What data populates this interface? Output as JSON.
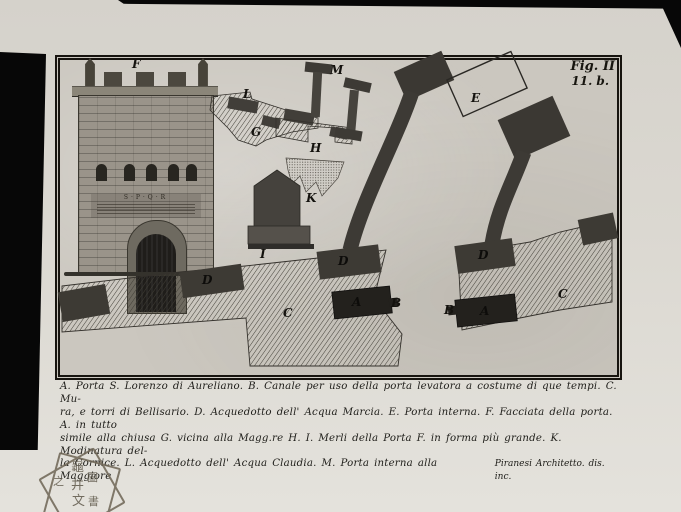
{
  "artwork": {
    "fig_label": "Fig. II",
    "fig_number": "11. b.",
    "signature": "Piranesi Architetto. dis. inc.",
    "facade_inscription": "S·P·Q·R",
    "caption": {
      "line1": "A. Porta S. Lorenzo di Aureliano. B. Canale per uso della porta levatora a costume di que tempi. C. Mu-",
      "line2": "ra, e torri di Bellisario. D. Acquedotto dell' Acqua Marcia. E. Porta interna. F. Facciata della porta. A. in tutto",
      "line3": "simile alla chiusa G. vicina alla Magg.re H. I. Merli della Porta F. in forma più grande. K. Modinatura del-",
      "line4": "la Cornice. L. Acquedotto dell' Acqua Claudia. M. Porta interna alla Maggiore"
    },
    "plan_labels": {
      "f": "F",
      "l": "L",
      "g": "G",
      "m": "M",
      "h": "H",
      "k": "K",
      "i": "I",
      "e": "E",
      "d1": "D",
      "d2": "D",
      "d3": "D",
      "a1": "A",
      "a2": "A",
      "b1": "B",
      "b2": "B",
      "c1": "C",
      "c2": "C"
    },
    "stamp_chars": {
      "c1": "龜",
      "c2": "井",
      "c3": "文",
      "c4": "之",
      "c5": "圖",
      "c6": "書"
    },
    "colors": {
      "paper": "#dbd8d1",
      "plate_tone": "#cbc7bf",
      "ink": "#1c1a16",
      "dark_pier": "#3d3a34",
      "gate_block": "#23211d",
      "backing_black": "#070707"
    }
  }
}
